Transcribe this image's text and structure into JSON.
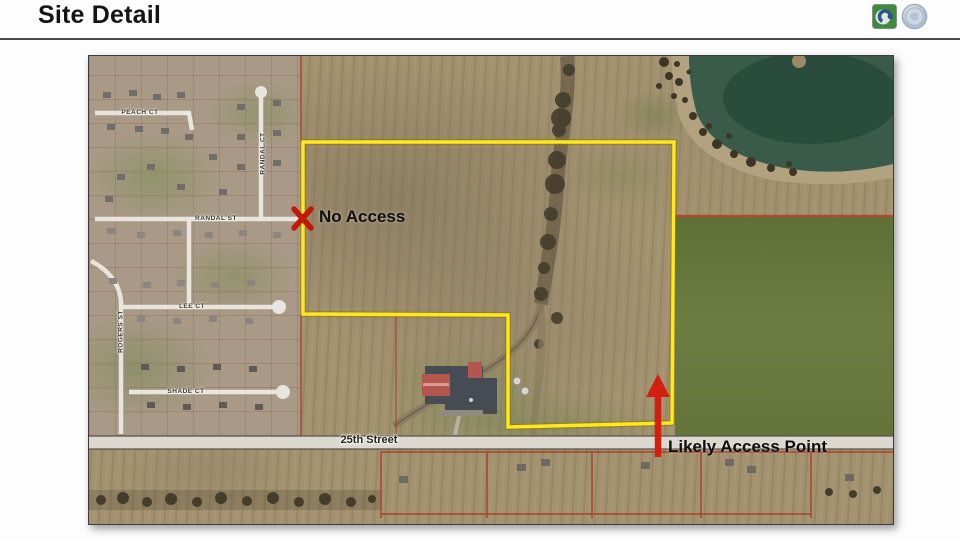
{
  "slide": {
    "title": "Site Detail"
  },
  "header_icons": [
    {
      "name": "recycle-logo-icon"
    },
    {
      "name": "seal-icon"
    }
  ],
  "map": {
    "annotations": {
      "no_access": "No Access",
      "likely_access_point": "Likely Access Point"
    },
    "street_labels": {
      "main_road": "25th Street",
      "peach_ct": "PEACH CT",
      "randal_ct": "RANDAL CT",
      "randal_st": "RANDAL ST",
      "lee_ct": "LEE CT",
      "rogers_st": "ROGERS ST",
      "shade_ct": "SHADE CT"
    },
    "colors": {
      "site_boundary": "#f7e61e",
      "marker_red": "#d42015",
      "parcel_line_red": "#a83c20"
    }
  }
}
